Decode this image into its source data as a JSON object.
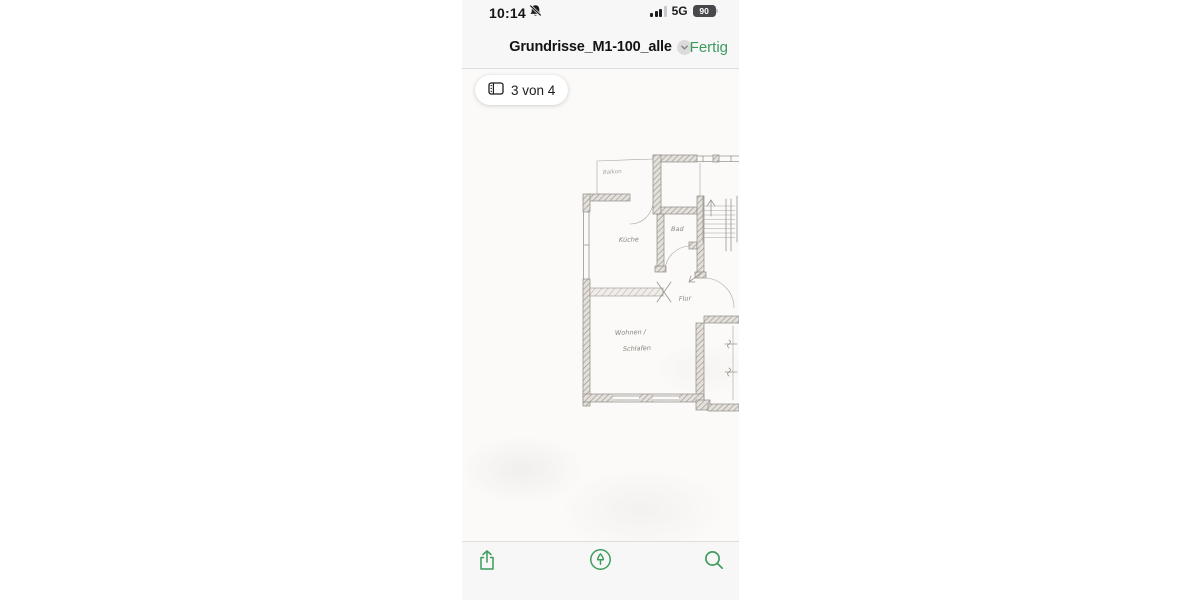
{
  "status_bar": {
    "time": "10:14",
    "network": "5G",
    "battery_percent": "90"
  },
  "nav_bar": {
    "title": "Grundrisse_M1-100_alle",
    "done_label": "Fertig"
  },
  "page_indicator": {
    "label": "3 von 4"
  },
  "floor_plan": {
    "description": "hand-drawn pencil floor plan scan, page 3 of 4",
    "labels": {
      "balkon": "Balkon",
      "kueche": "Küche",
      "bad": "Bad",
      "flur": "Flur",
      "wohnen_line1": "Wohnen /",
      "wohnen_line2": "Schlafen"
    }
  },
  "icons": {
    "status_bell": "bell-slash",
    "title_chevron": "chevron-down-circle",
    "page_indicator": "sidebar-pages",
    "share": "share-arrow-up",
    "markup": "markup-pen-circle",
    "search": "magnifier"
  },
  "colors": {
    "accent_green": "#3c9c5c",
    "chrome_bg": "#f8f7f7",
    "border": "#dedcdc",
    "paper": "#fbfaf8",
    "pencil": "#8f8b87",
    "text_dark": "#141414"
  }
}
